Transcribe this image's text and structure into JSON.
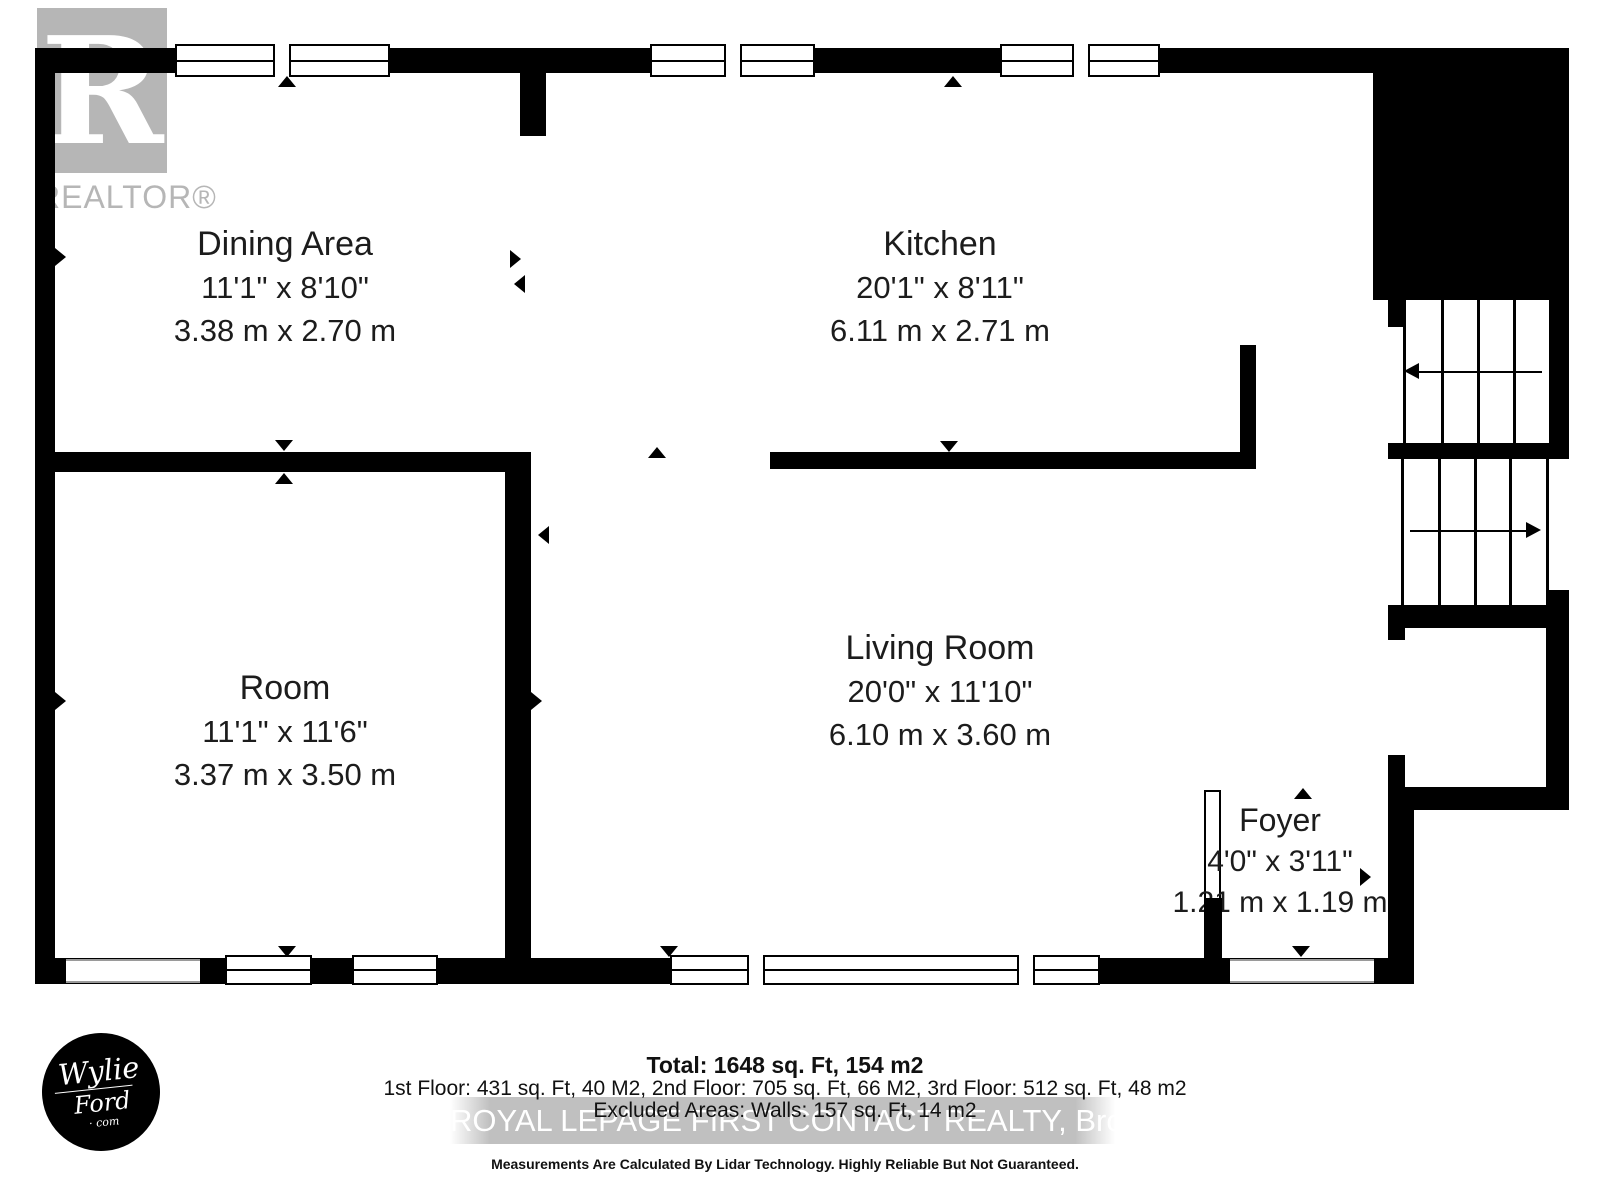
{
  "branding": {
    "realtor_logo_letter": "R",
    "realtor_logo_text": "REALTOR®",
    "wylie_line1": "Wylie",
    "wylie_line2": "Ford",
    "wylie_line3": "· com"
  },
  "rooms": [
    {
      "name": "Dining Area",
      "imperial": "11'1\" x 8'10\"",
      "metric": "3.38 m x 2.70 m"
    },
    {
      "name": "Kitchen",
      "imperial": "20'1\" x 8'11\"",
      "metric": "6.11 m x 2.71 m"
    },
    {
      "name": "Room",
      "imperial": "11'1\" x 11'6\"",
      "metric": "3.37 m x 3.50 m"
    },
    {
      "name": "Living Room",
      "imperial": "20'0\" x 11'10\"",
      "metric": "6.10 m x 3.60 m"
    },
    {
      "name": "Foyer",
      "imperial": "4'0\" x 3'11\"",
      "metric": "1.21 m x 1.19 m"
    }
  ],
  "footer": {
    "total": "Total: 1648 sq. Ft, 154 m2",
    "floors": "1st Floor: 431 sq. Ft, 40 M2, 2nd Floor: 705 sq. Ft, 66 M2, 3rd Floor: 512 sq. Ft, 48 m2",
    "excluded": "Excluded Areas: Walls: 157 sq. Ft, 14 m2",
    "watermark": "ROYAL LEPAGE FIRST CONTACT REALTY, Brokerage",
    "disclaimer": "Measurements Are Calculated By Lidar Technology. Highly Reliable But Not Guaranteed."
  },
  "colors": {
    "wall": "#000000",
    "logo_gray": "#b6b6b6",
    "label_text": "#1c1c1c",
    "watermark_bg": "#b9b9b9",
    "watermark_text": "#ffffff"
  }
}
